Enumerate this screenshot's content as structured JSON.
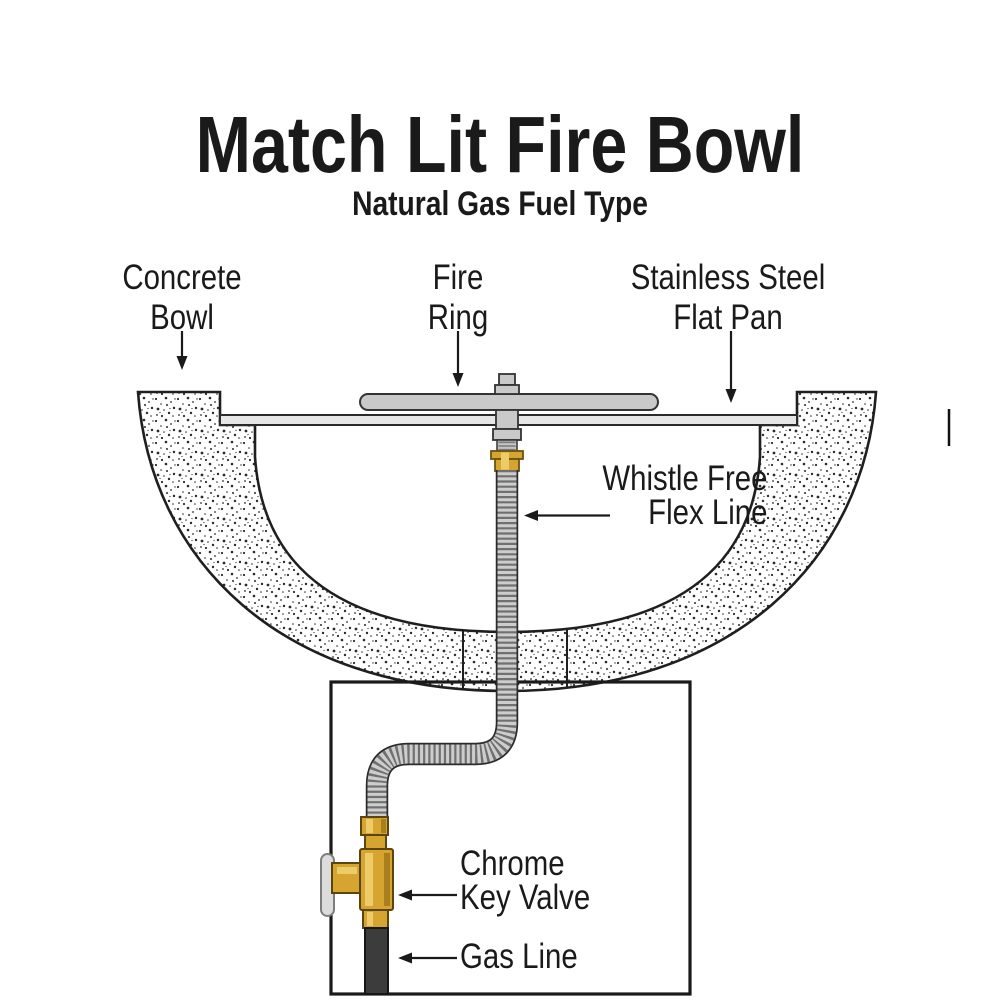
{
  "header": {
    "title": "Match Lit Fire Bowl",
    "subtitle": "Natural Gas Fuel Type"
  },
  "diagram": {
    "labels": {
      "concrete_bowl": {
        "line1": "Concrete",
        "line2": "Bowl"
      },
      "fire_ring": {
        "line1": "Fire",
        "line2": "Ring"
      },
      "flat_pan": {
        "line1": "Stainless Steel",
        "line2": "Flat Pan"
      },
      "flex_line": {
        "line1": "Whistle Free",
        "line2": "Flex Line"
      },
      "key_valve": {
        "line1": "Chrome",
        "line2": "Key Valve"
      },
      "gas_line": {
        "line1": "Gas Line"
      }
    }
  },
  "colors": {
    "brass": "#D6A52F",
    "brass_highlight": "#ECCB68",
    "brass_shadow": "#A87F1C",
    "steel": "#C9C9C9",
    "pan": "#E6E6E6",
    "flex_body": "#CDCDCD",
    "flex_rib": "#707070",
    "gas": "#3C3C3C",
    "chrome": "#DCDCDC",
    "ink": "#1A1A1A"
  }
}
